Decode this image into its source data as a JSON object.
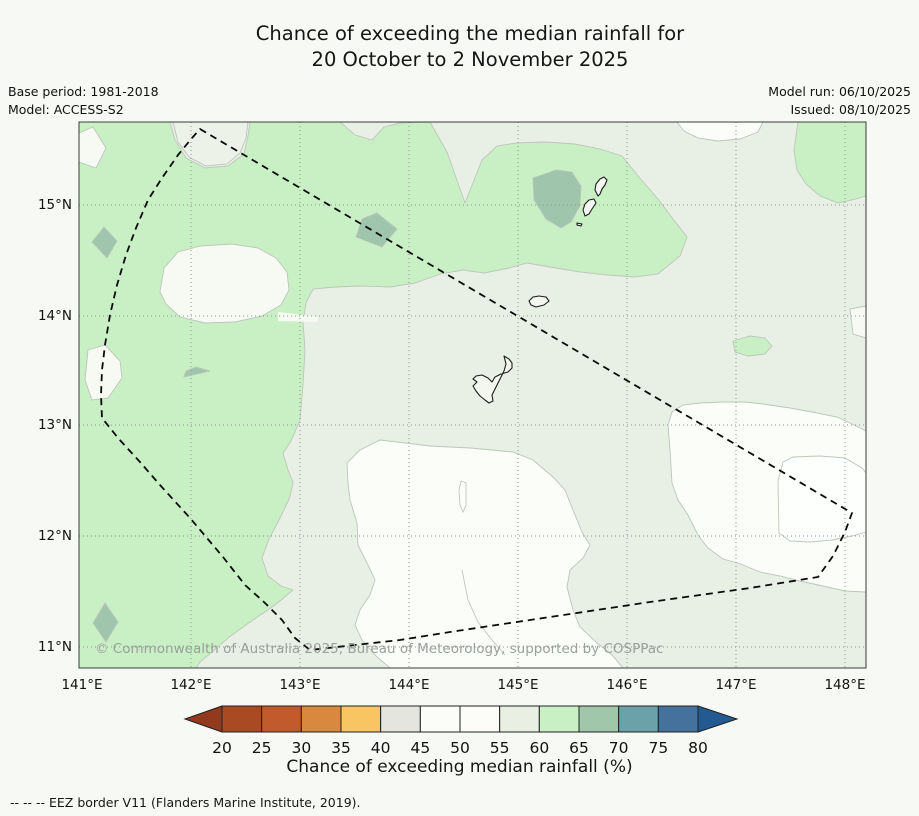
{
  "title": {
    "line1": "Chance of exceeding the median rainfall for",
    "line2": "20 October to 2 November 2025"
  },
  "meta": {
    "base_period": "Base period: 1981-2018",
    "model": "Model: ACCESS-S2",
    "model_run": "Model run: 06/10/2025",
    "issued": "Issued: 08/10/2025"
  },
  "map": {
    "copyright": "© Commonwealth of Australia 2025, Bureau of Meteorology, supported by COSPPac",
    "x_axis": {
      "ticks": [
        {
          "label": "141°E",
          "x": 82,
          "grid": false
        },
        {
          "label": "142°E",
          "x": 191,
          "grid": true
        },
        {
          "label": "143°E",
          "x": 300,
          "grid": true
        },
        {
          "label": "144°E",
          "x": 409,
          "grid": true
        },
        {
          "label": "145°E",
          "x": 518,
          "grid": true
        },
        {
          "label": "146°E",
          "x": 627,
          "grid": true
        },
        {
          "label": "147°E",
          "x": 736,
          "grid": true
        },
        {
          "label": "148°E",
          "x": 845,
          "grid": true
        }
      ]
    },
    "y_axis": {
      "ticks": [
        {
          "label": "15°N",
          "y": 205
        },
        {
          "label": "14°N",
          "y": 316
        },
        {
          "label": "13°N",
          "y": 425
        },
        {
          "label": "12°N",
          "y": 536
        },
        {
          "label": "11°N",
          "y": 647
        }
      ]
    },
    "border_name": "EEZ border (Guam region)",
    "islands": [
      "Saipan",
      "Tinian",
      "Aguijan",
      "Rota",
      "Guam"
    ]
  },
  "palette": {
    "page_bg": "#f7faf4",
    "chance_40_45": "#e4e5df",
    "chance_45_50": "#fdfffc",
    "chance_50_55": "#fbfdf9",
    "chance_55_60": "#e8efe5",
    "chance_60_65": "#c9f0c5",
    "chance_65_70": "#9fc6ad",
    "pale_50_55": "#f7faf3",
    "notch_55_60": "#edf2e9",
    "island_fill": "#f3f7f0"
  },
  "colorbar": {
    "title": "Chance of exceeding median rainfall (%)",
    "tick_labels": [
      "20",
      "25",
      "30",
      "35",
      "40",
      "45",
      "50",
      "55",
      "60",
      "65",
      "70",
      "75",
      "80"
    ],
    "segment_colors": [
      "#a94a23",
      "#c25b2c",
      "#d8893f",
      "#f9c462",
      "#e4e5df",
      "#fbfdf8",
      "#fcfdf9",
      "#e9efe3",
      "#c9efc4",
      "#a0c7a9",
      "#6ba1a9",
      "#44729d"
    ],
    "under_arrow_color": "#93391d",
    "over_arrow_color": "#235a92"
  },
  "footnote": "--  --  -- EEZ border V11 (Flanders Marine Institute, 2019)."
}
